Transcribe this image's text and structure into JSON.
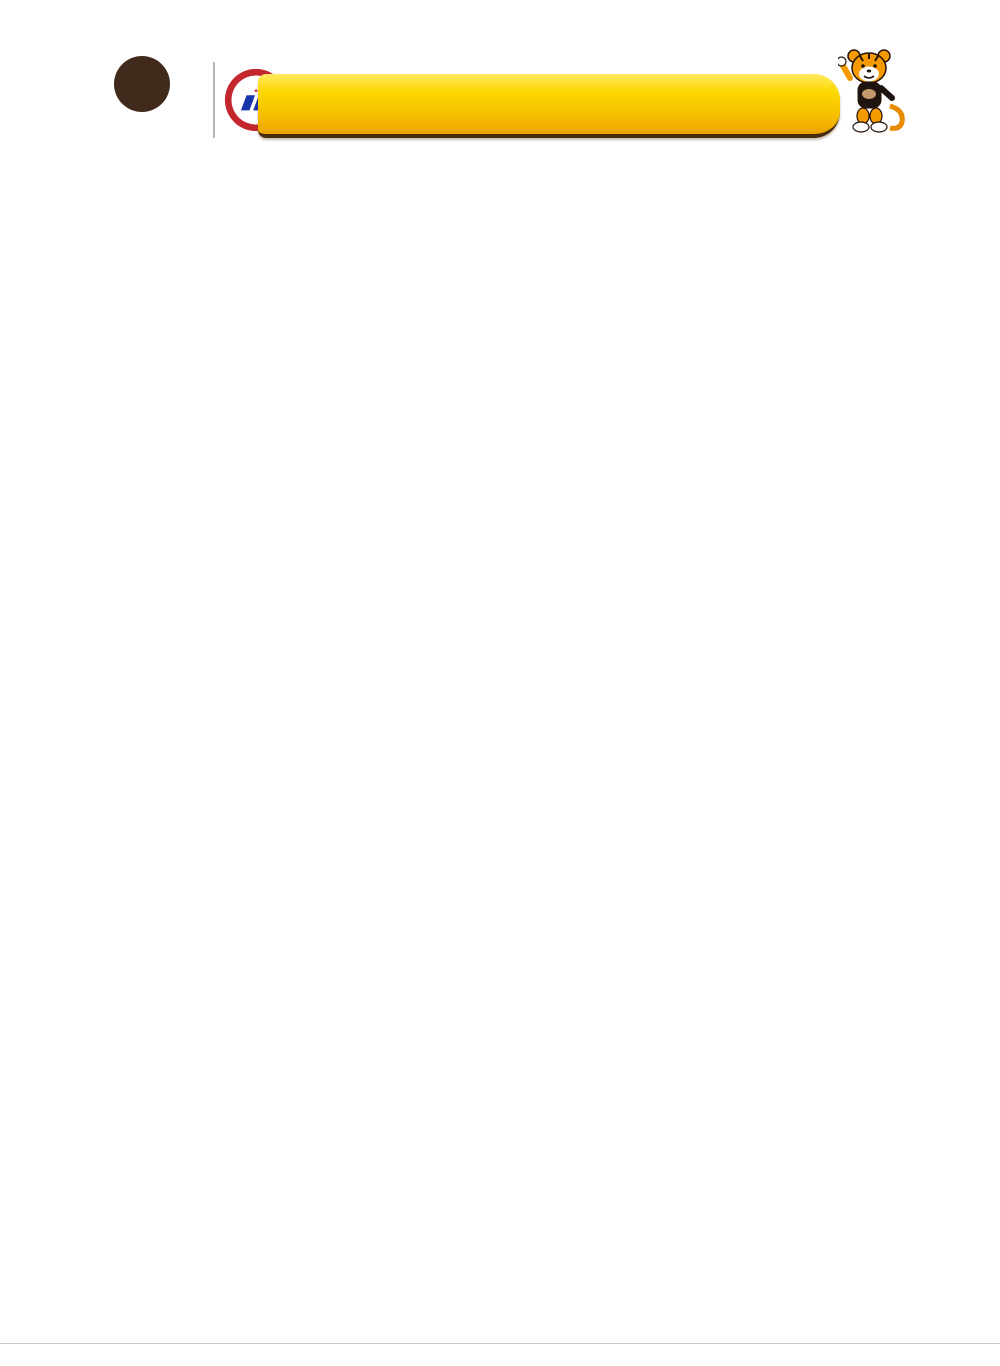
{
  "header": {
    "logo_letter": "W",
    "logo_reg": "®",
    "logo_text": "WACANG",
    "badge_top": "中国名牌",
    "badge_ring": "CHINA TOP BRAND",
    "badge_dates": "2007.9·2012.9",
    "banner_line1": "中国驰名商标",
    "banner_line2": "中国名牌产品",
    "brand_left": "专业品牌",
    "brand_right": "伟昌铝材",
    "brand_en": "EXPERT BRAND WEICHANG ALUMINIUM"
  },
  "page_title": "WGR18节能推拉窗截面图",
  "table_header": {
    "code": "代 号",
    "name": "名 称",
    "thickness": "壁 厚 (Tmm)",
    "weight": "重 量 (kg/m)",
    "legend": "图　例"
  },
  "columns": [
    [
      {
        "code": "WGR1801",
        "name": "平上滑",
        "t": "T=1.4",
        "w": "1.398kg/m",
        "d": {
          "shape": "raildown",
          "tl": [
            "WGR1801A",
            "WGR1801A"
          ],
          "ld": [
            "35.5"
          ],
          "bd": [
            "76.2"
          ]
        }
      },
      {
        "code": "WGR1811",
        "name": "固上滑",
        "t": "T=1.4",
        "w": "1.473kg/m",
        "d": {
          "shape": "raildown",
          "tl": [
            "WGR1811B",
            "WGR1801A"
          ],
          "ld": [
            "35.5"
          ],
          "bd": [
            "76.2"
          ]
        }
      },
      {
        "code": "WGR1841",
        "name": "固上滑",
        "t": "T=1.4",
        "w": "1.292kg/m",
        "d": {
          "shape": "raildown",
          "tl": [
            "WGR1841A",
            "WGR1841A"
          ],
          "ld": [
            "35.5"
          ],
          "bd": [
            "76.2"
          ]
        }
      },
      {
        "code": "WGR1851",
        "name": "固上滑",
        "t": "T=1.4",
        "w": "1.368kg/m",
        "d": {
          "shape": "raildown",
          "tl": [
            "WGR1851B",
            "WGR1841A"
          ],
          "ld": [
            "35.5"
          ],
          "bd": [
            "76.2"
          ]
        }
      },
      {
        "code": "WGR1802",
        "name": "下 滑",
        "t": "T=1.4",
        "w": "1.426kg/m",
        "d": {
          "shape": "railup",
          "tl": [
            "WGR1802A",
            "WGR1802B"
          ],
          "ld": [
            "48"
          ],
          "bd": [
            "76.2"
          ]
        }
      },
      {
        "code": "WGR1812",
        "name": "固下滑",
        "t": "T=1.4",
        "w": "1.497kg/m",
        "d": {
          "shape": "railup",
          "tl": [
            "WGR1802A",
            "WGR1812B"
          ],
          "ld": [
            "48"
          ],
          "bd": [
            "76.2"
          ]
        }
      },
      {
        "code": "WGR1832",
        "name": "下 滑",
        "t": "T=1.4",
        "w": "1.472kg/m",
        "d": {
          "shape": "railup",
          "td": [
            "76.2"
          ],
          "tl": [
            "WGR1832A",
            "WGR1802B"
          ],
          "ld": [
            "60"
          ]
        }
      },
      {
        "code": "WGR1842",
        "name": "固下滑",
        "t": "T=1.4",
        "w": "1.543kg/m",
        "d": {
          "shape": "railup",
          "tl": [
            "WGR1832A",
            "WGR1812B"
          ],
          "ld": [
            "60"
          ],
          "bd": [
            "76.2"
          ]
        }
      },
      {
        "code": "WGR1803",
        "name": "边 封",
        "t": "T=1.4",
        "w": "1.263kg/m",
        "d": {
          "shape": "hbox",
          "tl": [
            "WGR1803A",
            "WGR1803B"
          ],
          "ld": [
            "36"
          ],
          "bd": [
            "80"
          ]
        }
      },
      {
        "code": "WGR1804",
        "name": "上下方",
        "t": "T=1.4",
        "w": "0.932kg/m",
        "d": {
          "shape": "box",
          "tl": [
            "WGR1804A"
          ],
          "bl": [
            "WGR1804B"
          ],
          "ld": [
            "17"
          ],
          "rd": [
            "22.2"
          ],
          "bd": [
            "63"
          ]
        }
      }
    ],
    [
      {
        "code": "WGR1806",
        "name": "光 企",
        "t": "T=1.4",
        "w": "0.771kg/m",
        "note": "配收口 WGR1840",
        "d": {
          "shape": "box",
          "tl": [
            "WGR1806A"
          ],
          "bl": [
            "WGR1806B"
          ],
          "ld": [
            "28.8"
          ],
          "rd": [
            "22.2"
          ],
          "bd": [
            "49"
          ]
        }
      },
      {
        "code": "WGR1807",
        "name": "勾 企",
        "t": "T=1.4",
        "w": "1.011kg/m",
        "d": {
          "shape": "hook",
          "tl": [
            "WGR1807A"
          ],
          "sl": [
            "WGR1817"
          ],
          "bl": [
            "WGR1806B"
          ],
          "rd": [
            "22.2",
            "28.8"
          ],
          "bd": [
            "49"
          ]
        }
      },
      {
        "code": "WGR1834",
        "name": "中空上下方",
        "t": "T=1.4",
        "w": "0.949kg/m",
        "d": {
          "shape": "hbox",
          "tl": [
            "WGR1834B"
          ],
          "bl": [
            "WGR1834A"
          ],
          "ld": [
            "25"
          ],
          "rd": [
            "26"
          ],
          "bd": [
            "63"
          ]
        }
      },
      {
        "code": "WGR1836",
        "name": "中空光企",
        "t": "T=1.4",
        "w": "0.82kg/m",
        "d": {
          "shape": "box",
          "tl": [
            "WGR1836A"
          ],
          "bl": [
            "WGR1836B"
          ],
          "rd": [
            "26"
          ],
          "bd": [
            "49"
          ]
        }
      },
      {
        "code": "WGR1847",
        "name": "中空勾企",
        "t": "T=1.4",
        "w": "0.991kg/m",
        "d": {
          "shape": "hook",
          "td": [
            "49"
          ],
          "tl": [
            "WGR1836B"
          ],
          "sl": [
            "WGR1817"
          ],
          "bl": [
            "WGR1847A"
          ],
          "rd": [
            "26"
          ]
        }
      },
      {
        "code": "WGR1816",
        "name": "窗 扇",
        "t": "T=1.4",
        "w": "1.03kg/m",
        "note": "配 WGR1840",
        "d": {
          "shape": "box",
          "tl": [
            "WGR1816A"
          ],
          "bl": [
            "WGR1816A"
          ],
          "ld": [
            "28.8"
          ],
          "bd": [
            "66"
          ]
        }
      },
      {
        "code": "WGR1837",
        "name": "勾企板",
        "t": "T=1.4",
        "w": "0.265kg/m",
        "note": "配 WGR1816/1826",
        "d": {
          "shape": "plate",
          "ld": [
            "34"
          ],
          "bd": [
            "14.6"
          ]
        }
      },
      {
        "code": "WGR18G07",
        "name": "勾企板",
        "t": "T=1.4",
        "w": "0.28kg/m",
        "note": "配 WGR1816/1826",
        "d": {
          "shape": "plate",
          "ld": [
            "35.9"
          ],
          "bd": [
            "17.5"
          ]
        }
      },
      {
        "code": "WGR1808",
        "name": "上固定",
        "t": "T=1.4",
        "w": "1.209kg/m",
        "d": {
          "shape": "hbox",
          "tl": [
            "WGR1808B",
            "WGR1808A"
          ],
          "ld": [
            "38.7"
          ],
          "bd": [
            "76.2"
          ]
        }
      },
      {
        "code": "WGR1809",
        "name": "中 柱",
        "t": "T=1.4",
        "w": "1.282kg/m",
        "d": {
          "shape": "hbox",
          "tl": [
            "WGR1809B",
            "WGR1808A"
          ],
          "ld": [
            "57.4",
            "20"
          ],
          "bd": [
            "75.8"
          ]
        }
      }
    ],
    [
      {
        "code": "WGR1810",
        "name": "边封插板",
        "t": "T=1.4",
        "w": "0.869kg/m",
        "d": {
          "shape": "hbox",
          "tl": [
            "WGR1810B",
            "WGR1810A"
          ],
          "ld": [
            "18"
          ],
          "bd": [
            "76.2"
          ]
        }
      },
      {
        "code": "WGR1820",
        "name": "拼 管",
        "t": "T=1.4",
        "w": "1.134kg/m",
        "d": {
          "shape": "hbox",
          "tl": [
            "WGR1808A",
            "WGR1808A"
          ],
          "rd": [
            "20"
          ],
          "bd": [
            "76.2"
          ]
        }
      },
      {
        "code": "WGR6515",
        "name": "压 条",
        "t": "T=1.0",
        "w": "0.186kg/m",
        "d": {
          "shape": "bead",
          "td": [
            "12.1",
            "33.3"
          ],
          "rd": [
            "18.55"
          ]
        }
      },
      {
        "code": "WGR6535",
        "name": "压 条",
        "t": "T=1.0",
        "w": "0.23kg/m",
        "d": {
          "shape": "bead",
          "td": [
            "13.8",
            "31.6"
          ],
          "rd": [
            "18.55"
          ]
        }
      },
      {
        "code": "WGR6505",
        "name": "压 条",
        "t": "T=1.0",
        "w": "0.161kg/m",
        "d": {
          "shape": "bead",
          "td": [
            "22.1",
            "23.3"
          ],
          "rd": [
            "18.55"
          ]
        }
      },
      {
        "code": "WGR2505",
        "name": "压 条",
        "t": "T=1.0",
        "w": "0.195kg/m",
        "d": {
          "shape": "bead",
          "td": [
            "22.1",
            "23.3"
          ],
          "rd": [
            "18.55"
          ]
        }
      },
      {
        "code": "WGR2535",
        "name": "压 条",
        "t": "T=1.0",
        "w": "0.193kg/m",
        "d": {
          "shape": "bead2",
          "td": [
            "25.1"
          ],
          "rd": [
            "18.55"
          ]
        }
      },
      {
        "code": "WGR2545",
        "name": "压 条",
        "t": "T=1.0",
        "w": "0.19kg/m",
        "d": {
          "shape": "bead2",
          "td": [
            "26.1"
          ],
          "rd": [
            "18.55"
          ]
        }
      },
      {
        "code": "WGR1840",
        "name": "收 口",
        "t": "T=1.2",
        "w": "0.504kg/m",
        "d": {
          "shape": "cap",
          "tl": [
            "WGR1840A",
            "WGR1840A"
          ],
          "bd": [
            "20.4"
          ]
        }
      },
      {
        "code": "WGR1850",
        "name": "扣 条",
        "t": "T=1.4",
        "w": "0.221kg/m",
        "d": {
          "shape": "angle",
          "bd": [
            "30.5"
          ],
          "rd": [
            "18.55"
          ]
        }
      }
    ]
  ],
  "footer": {
    "note_line1": "图中所示为铝材基材标准厚度和理论重量（含隔热条重量）不含表面涂层及包装重量，",
    "note_line2": "客户可根据需要的厚度订购，实际重量以过磅时的重量为准。",
    "page_number": "21/",
    "page_label_line1": "Expert Brand",
    "page_label_line2": "Weichang Aluminium"
  },
  "colors": {
    "banner_yellow": "#fcd000",
    "banner_brown": "#4a2c10",
    "brand_text": "#4d2c0e",
    "blue_text": "#1535a8",
    "table_border": "#8a7260",
    "band_brown": "#5a3b22",
    "maroon": "#7c2125",
    "legend_text": "#7b5b45",
    "page_blue": "#1766b3",
    "diagram": {
      "line": "#a9a29c",
      "line2": "#8d8179",
      "pink": "#dcb0ac",
      "dash": "#c6bfb9",
      "dim": "#968a80",
      "text": "#564e47"
    }
  }
}
